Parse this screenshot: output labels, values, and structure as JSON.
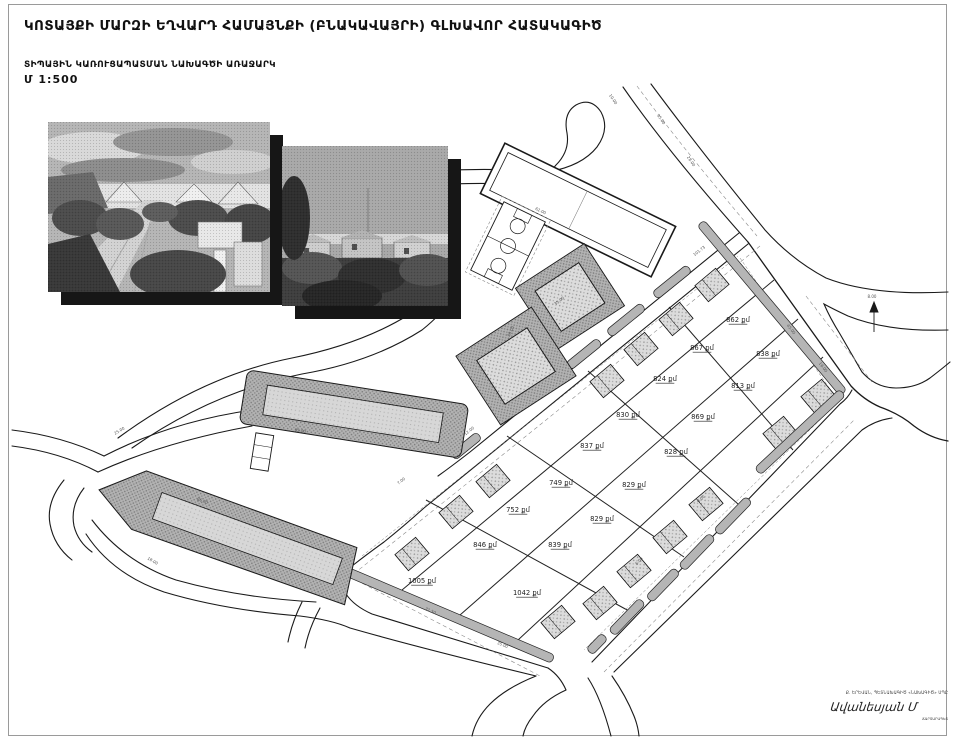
{
  "header": {
    "title": "ԿՈՏԱՅՔԻ ՄԱՐԶԻ ԵՂՎԱՐԴ ՀԱՄԱՅՆՔԻ (ԲՆԱԿԱՎԱՅՐԻ) ԳԼԽԱՎՈՐ ՀԱՏԱԿԱԳԻԾ",
    "subtitle": "ՏԻՊԱՅԻՆ ԿԱՌՈՒՑԱՊԱՏՄԱՆ ՆԱԽԱԳԾԻ ԱՌԱՋԱՐԿ",
    "scale": "Մ 1:500"
  },
  "stamp": {
    "line1": "Ք. ԵՐԵՎԱՆ, ՊԵՏՆԱԽԱԳԻԾ «ՆԱԽԱԳԻԾ» ՍՊԸ",
    "signature": "Ավանեսյան Մ",
    "line3": "ՃԱՐՏԱՐԱՊԵՏ"
  },
  "plan": {
    "unit_suffix": "քմ",
    "colors": {
      "road": "#1a1a1a",
      "strip": "#b5b5b5",
      "dash": "#8a8a8a",
      "label": "#1f1f1f",
      "dim": "#555555"
    },
    "parcels": [
      {
        "x": 738,
        "y": 322,
        "t": "862 քմ"
      },
      {
        "x": 768,
        "y": 356,
        "t": "838 քմ"
      },
      {
        "x": 702,
        "y": 350,
        "t": "867 քմ"
      },
      {
        "x": 665,
        "y": 381,
        "t": "824 քմ"
      },
      {
        "x": 743,
        "y": 388,
        "t": "813 քմ"
      },
      {
        "x": 628,
        "y": 417,
        "t": "830 քմ"
      },
      {
        "x": 703,
        "y": 419,
        "t": "869 քմ"
      },
      {
        "x": 592,
        "y": 448,
        "t": "837 քմ"
      },
      {
        "x": 676,
        "y": 454,
        "t": "828 քմ"
      },
      {
        "x": 561,
        "y": 485,
        "t": "749 քմ"
      },
      {
        "x": 634,
        "y": 487,
        "t": "829 քմ"
      },
      {
        "x": 518,
        "y": 512,
        "t": "752 քմ"
      },
      {
        "x": 602,
        "y": 521,
        "t": "829 քմ"
      },
      {
        "x": 485,
        "y": 547,
        "t": "846 քմ"
      },
      {
        "x": 560,
        "y": 547,
        "t": "839 քմ"
      },
      {
        "x": 422,
        "y": 583,
        "t": "1005 քմ"
      },
      {
        "x": 527,
        "y": 595,
        "t": "1042 քմ"
      }
    ],
    "footprints": [
      [
        712,
        285
      ],
      [
        676,
        319
      ],
      [
        641,
        349
      ],
      [
        607,
        381
      ],
      [
        818,
        396
      ],
      [
        780,
        433
      ],
      [
        493,
        481
      ],
      [
        456,
        512
      ],
      [
        412,
        554
      ],
      [
        706,
        504
      ],
      [
        670,
        537
      ],
      [
        634,
        571
      ],
      [
        600,
        603
      ],
      [
        558,
        622
      ]
    ],
    "strips": [
      [
        772,
        308,
        222,
        50
      ],
      [
        800,
        432,
        116,
        137
      ],
      [
        733,
        516,
        46,
        134
      ],
      [
        697,
        552,
        44,
        134
      ],
      [
        663,
        585,
        40,
        134
      ],
      [
        627,
        617,
        44,
        134
      ],
      [
        597,
        644,
        22,
        134
      ],
      [
        672,
        282,
        44,
        141
      ],
      [
        626,
        320,
        44,
        141
      ],
      [
        584,
        354,
        40,
        141
      ],
      [
        466,
        446,
        34,
        141
      ],
      [
        449,
        615,
        226,
        23
      ],
      [
        344,
        564,
        24,
        110
      ]
    ],
    "grid_rows": [
      [
        774,
        280,
        402,
        590
      ],
      [
        798,
        319,
        460,
        615
      ],
      [
        823,
        357,
        518,
        640
      ]
    ],
    "grid_cols": [
      [
        669,
        307,
        793,
        450
      ],
      [
        588,
        371,
        738,
        504
      ],
      [
        507,
        436,
        684,
        557
      ],
      [
        426,
        500,
        629,
        611
      ]
    ],
    "setback_dashes": [
      [
        740,
        258,
        836,
        398
      ],
      [
        828,
        412,
        584,
        650
      ],
      [
        362,
        556,
        738,
        256
      ],
      [
        362,
        576,
        554,
        660
      ]
    ],
    "dims": [
      {
        "x": 660,
        "y": 120,
        "r": 56,
        "t": "35.00"
      },
      {
        "x": 690,
        "y": 162,
        "r": 56,
        "t": "28.00"
      },
      {
        "x": 612,
        "y": 100,
        "r": 56,
        "t": "10.00"
      },
      {
        "x": 790,
        "y": 330,
        "r": 53,
        "t": "45.00"
      },
      {
        "x": 822,
        "y": 368,
        "r": 53,
        "t": "16.00"
      },
      {
        "x": 700,
        "y": 252,
        "r": -38,
        "t": "101.73"
      },
      {
        "x": 560,
        "y": 302,
        "r": -38,
        "t": "35.00"
      },
      {
        "x": 470,
        "y": 432,
        "r": -38,
        "t": "12.00"
      },
      {
        "x": 402,
        "y": 482,
        "r": -38,
        "t": "7.00"
      },
      {
        "x": 430,
        "y": 612,
        "r": 23,
        "t": "71.50"
      },
      {
        "x": 502,
        "y": 646,
        "r": 23,
        "t": "35.00"
      },
      {
        "x": 640,
        "y": 562,
        "r": -46,
        "t": "6.00"
      },
      {
        "x": 702,
        "y": 500,
        "r": -46,
        "t": "9.00"
      },
      {
        "x": 300,
        "y": 432,
        "r": 9,
        "t": "95.00"
      },
      {
        "x": 202,
        "y": 502,
        "r": 20,
        "t": "86.00"
      },
      {
        "x": 120,
        "y": 432,
        "r": -30,
        "t": "25.00"
      },
      {
        "x": 540,
        "y": 212,
        "r": 26,
        "t": "62.00"
      },
      {
        "x": 512,
        "y": 332,
        "r": -64,
        "t": "30.00"
      },
      {
        "x": 152,
        "y": 562,
        "r": 30,
        "t": "18.00"
      },
      {
        "x": 872,
        "y": 298,
        "r": 0,
        "t": "8.00"
      }
    ]
  }
}
